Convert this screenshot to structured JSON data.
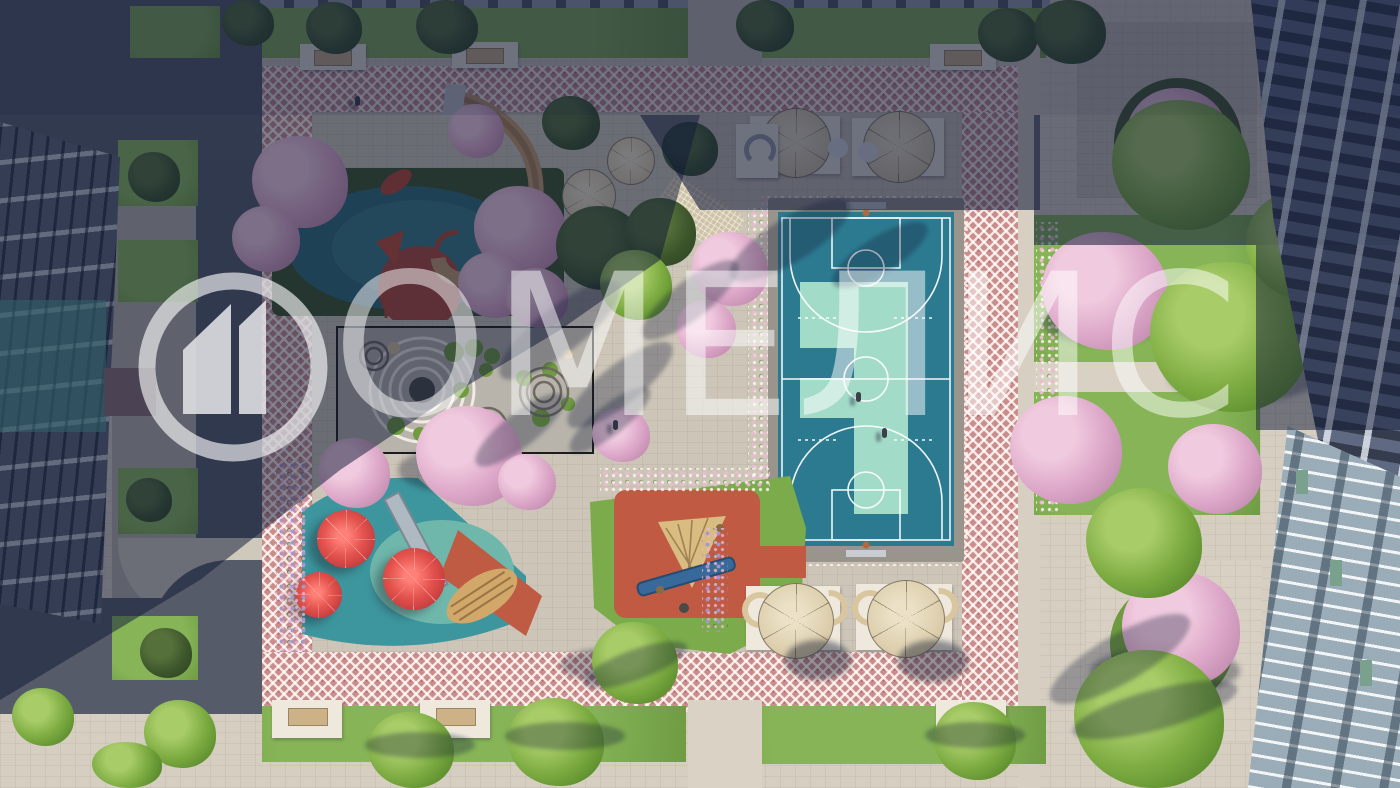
{
  "scene": {
    "type": "aerial-3d-architectural-render",
    "subject": "residential courtyard with playgrounds, zen garden, basketball court, gardens and apartment buildings",
    "lighting": "low sun with long diagonal shadow across upper-left"
  },
  "watermark": {
    "text": "ОМЕЛИС",
    "logo": "house-in-circle-logo",
    "color": "#ffffff",
    "opacity": 0.5
  },
  "palette": {
    "paving_sun": "#d5cec1",
    "paving_courtyard": "#cdc6b8",
    "mosaic_pink": "#c98d8b",
    "court_teal": "#2c7a90",
    "court_mint": "#a2dbc8",
    "play_teal": "#3f98a0",
    "play_terracotta": "#c05a43",
    "umbrella_red": "#d9484b",
    "slide_tan": "#c29b6e",
    "grass_sun": "#86b457",
    "blossom_pink": "#dda8c9",
    "asphalt": "#555b68",
    "building_left": "#5a6272",
    "building_right_glass": "#bcc8cf",
    "shadow_tint": "#111a38"
  },
  "elements": [
    "left-apartment-building",
    "right-apartment-building",
    "top-building-strip",
    "dragon-slide-playground",
    "zen-garden",
    "toddler-water-playground",
    "climbing-playground",
    "basketball-court",
    "mosaic-walkway-frame",
    "picnic-parasol-tables",
    "hammock-lounger",
    "red-mushroom-umbrellas",
    "tree-planter-squares",
    "garden-beds",
    "benches",
    "pedestrians"
  ]
}
